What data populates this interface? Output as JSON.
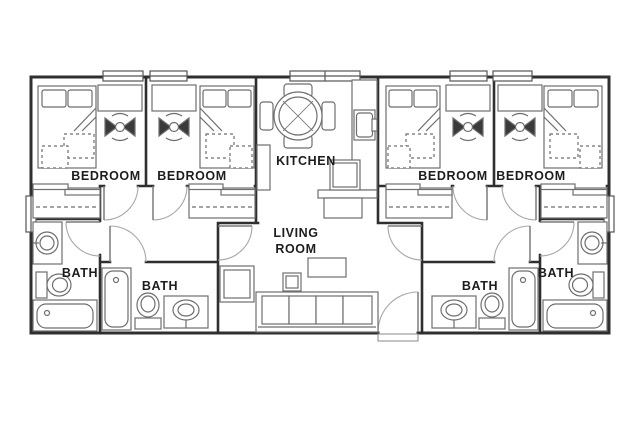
{
  "floor_plan": {
    "type": "apartment-floor-plan",
    "labels": {
      "bedroom": "BEDROOM",
      "kitchen": "KITCHEN",
      "living_room_lines": [
        "LIVING",
        "ROOM"
      ],
      "bath": "BATH"
    },
    "rooms": [
      {
        "id": "bedroom-1",
        "label": "BEDROOM"
      },
      {
        "id": "bedroom-2",
        "label": "BEDROOM"
      },
      {
        "id": "kitchen",
        "label": "KITCHEN"
      },
      {
        "id": "bedroom-3",
        "label": "BEDROOM"
      },
      {
        "id": "bedroom-4",
        "label": "BEDROOM"
      },
      {
        "id": "bath-1",
        "label": "BATH"
      },
      {
        "id": "bath-2",
        "label": "BATH"
      },
      {
        "id": "living-room",
        "label": "LIVING ROOM"
      },
      {
        "id": "bath-3",
        "label": "BATH"
      },
      {
        "id": "bath-4",
        "label": "BATH"
      }
    ],
    "colors": {
      "wall": "#2f2f2f",
      "furniture": "#6e6e6e",
      "door": "#a8a8a8",
      "leaf": "#7a7a7a",
      "chair_fill": "#3a3a3a",
      "text": "#1d1d1d",
      "background": "#ffffff"
    }
  }
}
